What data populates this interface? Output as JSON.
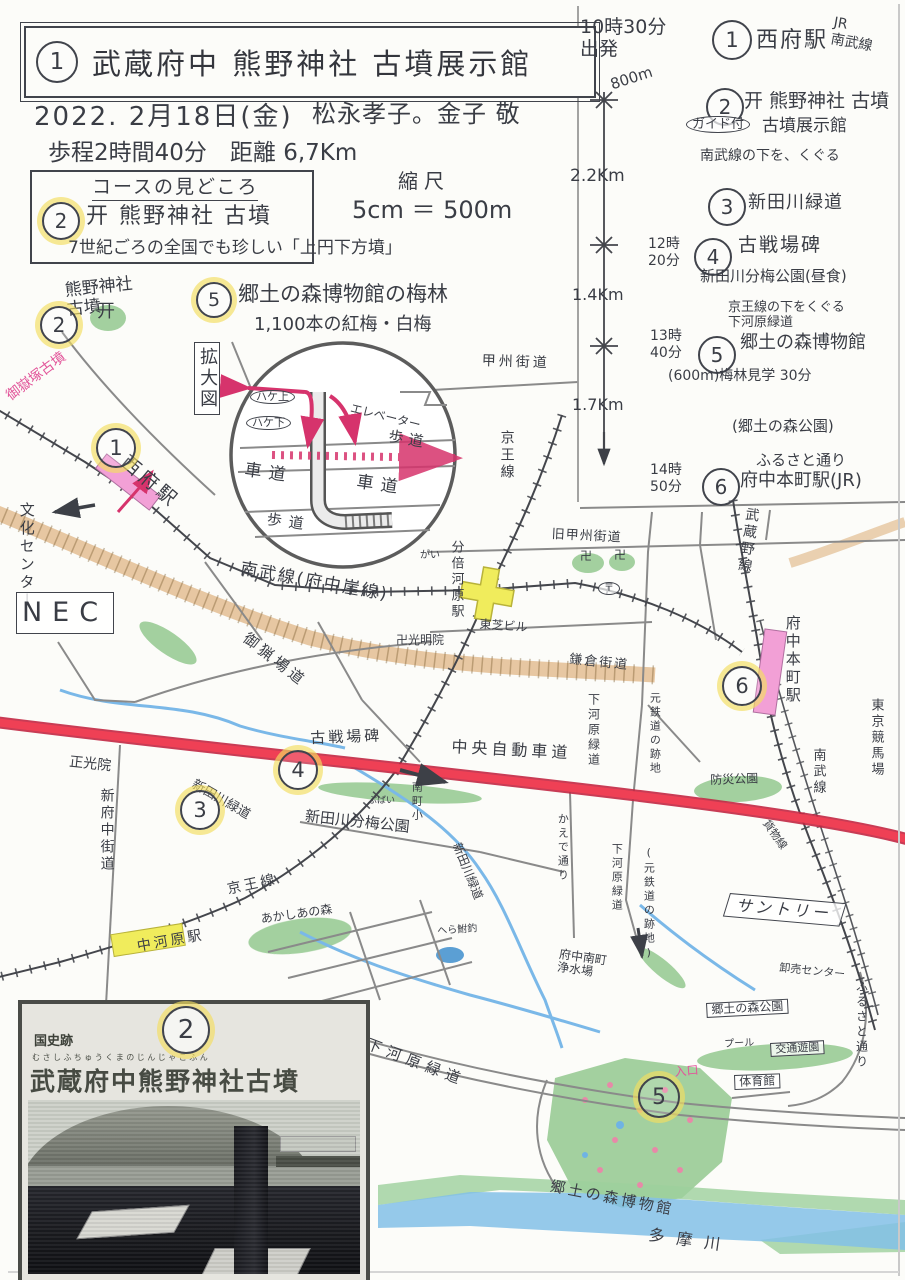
{
  "header": {
    "badge": "1",
    "title": "武蔵府中 熊野神社 古墳展示館",
    "date": "2022. 2月18日(金)",
    "names": "松永孝子。金子 敬",
    "stats": "歩程2時間40分　距離 6,7Km",
    "scale_label": "縮尺",
    "scale_value": "5cm ＝ 500m"
  },
  "highlights": {
    "title": "コースの見どころ",
    "item2_badge": "2",
    "item2_text": "开 熊野神社 古墳",
    "item2_note": "7世紀ごろの全国でも珍しい「上円下方墳」",
    "item5_badge": "5",
    "item5_text": "郷土の森博物館の梅林",
    "item5_note": "1,100本の紅梅・白梅"
  },
  "itinerary": {
    "depart": {
      "time_label": "10時30分\n出発"
    },
    "dists": [
      "800m",
      "2.2Km",
      "1.4Km",
      "1.7Km"
    ],
    "stops": [
      {
        "n": "1",
        "name": "西府駅",
        "note": "JR\n南武線"
      },
      {
        "n": "2",
        "name": "开 熊野神社 古墳",
        "tag": "ガイド付",
        "name2": "古墳展示館",
        "note": "南武線の下を、くぐる"
      },
      {
        "n": "3",
        "name": "新田川緑道"
      },
      {
        "n": "4",
        "time": "12時\n20分",
        "name": "古戦場碑",
        "note": "新田川分梅公園(昼食)",
        "after": "京王線の下をくぐる\n下河原緑道"
      },
      {
        "n": "5",
        "time": "13時\n40分",
        "name": "郷土の森博物館",
        "note": "(600m)梅林見学 30分",
        "note2": "(郷土の森公園)"
      },
      {
        "n": "6",
        "time": "14時\n50分",
        "pre": "ふるさと通り",
        "name": "府中本町駅(JR)"
      }
    ]
  },
  "map": {
    "labels": [
      {
        "t": "熊野神社\n古墳"
      },
      {
        "t": "御嶽塚古墳"
      },
      {
        "t": "西府駅"
      },
      {
        "t": "文化センター"
      },
      {
        "t": "NEC"
      },
      {
        "t": "拡大図"
      },
      {
        "t": "ハケ上"
      },
      {
        "t": "ハケ下"
      },
      {
        "t": "エレベーター"
      },
      {
        "t": "歩道"
      },
      {
        "t": "車道"
      },
      {
        "t": "車道"
      },
      {
        "t": "歩道"
      },
      {
        "t": "甲州街道"
      },
      {
        "t": "京王線"
      },
      {
        "t": "旧甲州街道"
      },
      {
        "t": "分倍河原駅"
      },
      {
        "t": "東芝ビル"
      },
      {
        "t": "卍光明院"
      },
      {
        "t": "御猟場道"
      },
      {
        "t": "南武線(府中崖線)"
      },
      {
        "t": "がい"
      },
      {
        "t": "鎌倉街道"
      },
      {
        "t": "武蔵野線"
      },
      {
        "t": "府中本町駅"
      },
      {
        "t": "東京競馬場"
      },
      {
        "t": "中央自動車道"
      },
      {
        "t": "古戦場碑"
      },
      {
        "t": "新田川緑道"
      },
      {
        "t": "ぶばい"
      },
      {
        "t": "新田川分梅公園"
      },
      {
        "t": "南町小"
      },
      {
        "t": "新田川緑道"
      },
      {
        "t": "正光院"
      },
      {
        "t": "新府中街道"
      },
      {
        "t": "京王線"
      },
      {
        "t": "中河原駅"
      },
      {
        "t": "あかしあの森"
      },
      {
        "t": "へら鮒釣"
      },
      {
        "t": "下河原緑道"
      },
      {
        "t": "下河原緑道"
      },
      {
        "t": "元鉄道の跡地"
      },
      {
        "t": "かえで通り"
      },
      {
        "t": "下河原緑道"
      },
      {
        "t": "(元鉄道の跡地)"
      },
      {
        "t": "防災公園"
      },
      {
        "t": "南武線"
      },
      {
        "t": "貨物線"
      },
      {
        "t": "サントリー"
      },
      {
        "t": "卸売センター"
      },
      {
        "t": "ふるさと通り"
      },
      {
        "t": "郷土の森公園"
      },
      {
        "t": "プール"
      },
      {
        "t": "交通遊園"
      },
      {
        "t": "体育館"
      },
      {
        "t": "入口"
      },
      {
        "t": "郷土の森博物館"
      },
      {
        "t": "多摩川"
      },
      {
        "t": "开"
      },
      {
        "t": "卍"
      },
      {
        "t": "卍"
      },
      {
        "t": "府中南町\n浄水場"
      },
      {
        "t": "〒"
      }
    ],
    "badges": [
      {
        "n": "2"
      },
      {
        "n": "1"
      },
      {
        "n": "3"
      },
      {
        "n": "4"
      },
      {
        "n": "6"
      },
      {
        "n": "5"
      }
    ]
  },
  "photo": {
    "badge": "2",
    "heritage": "国史跡",
    "furigana": "むさしふちゅうくまのじんじゃこふん",
    "title": "武蔵府中熊野神社古墳"
  },
  "colors": {
    "route_red": "#ef4055",
    "highlight_yellow": "#f3de60",
    "station_pink": "#f2a0d6",
    "station_yellow": "#f0ec5c",
    "park_green": "#93c88f",
    "water_blue": "#7ab8e8",
    "ink_pink": "#e2559a",
    "cliff_tan": "#d8a468"
  }
}
